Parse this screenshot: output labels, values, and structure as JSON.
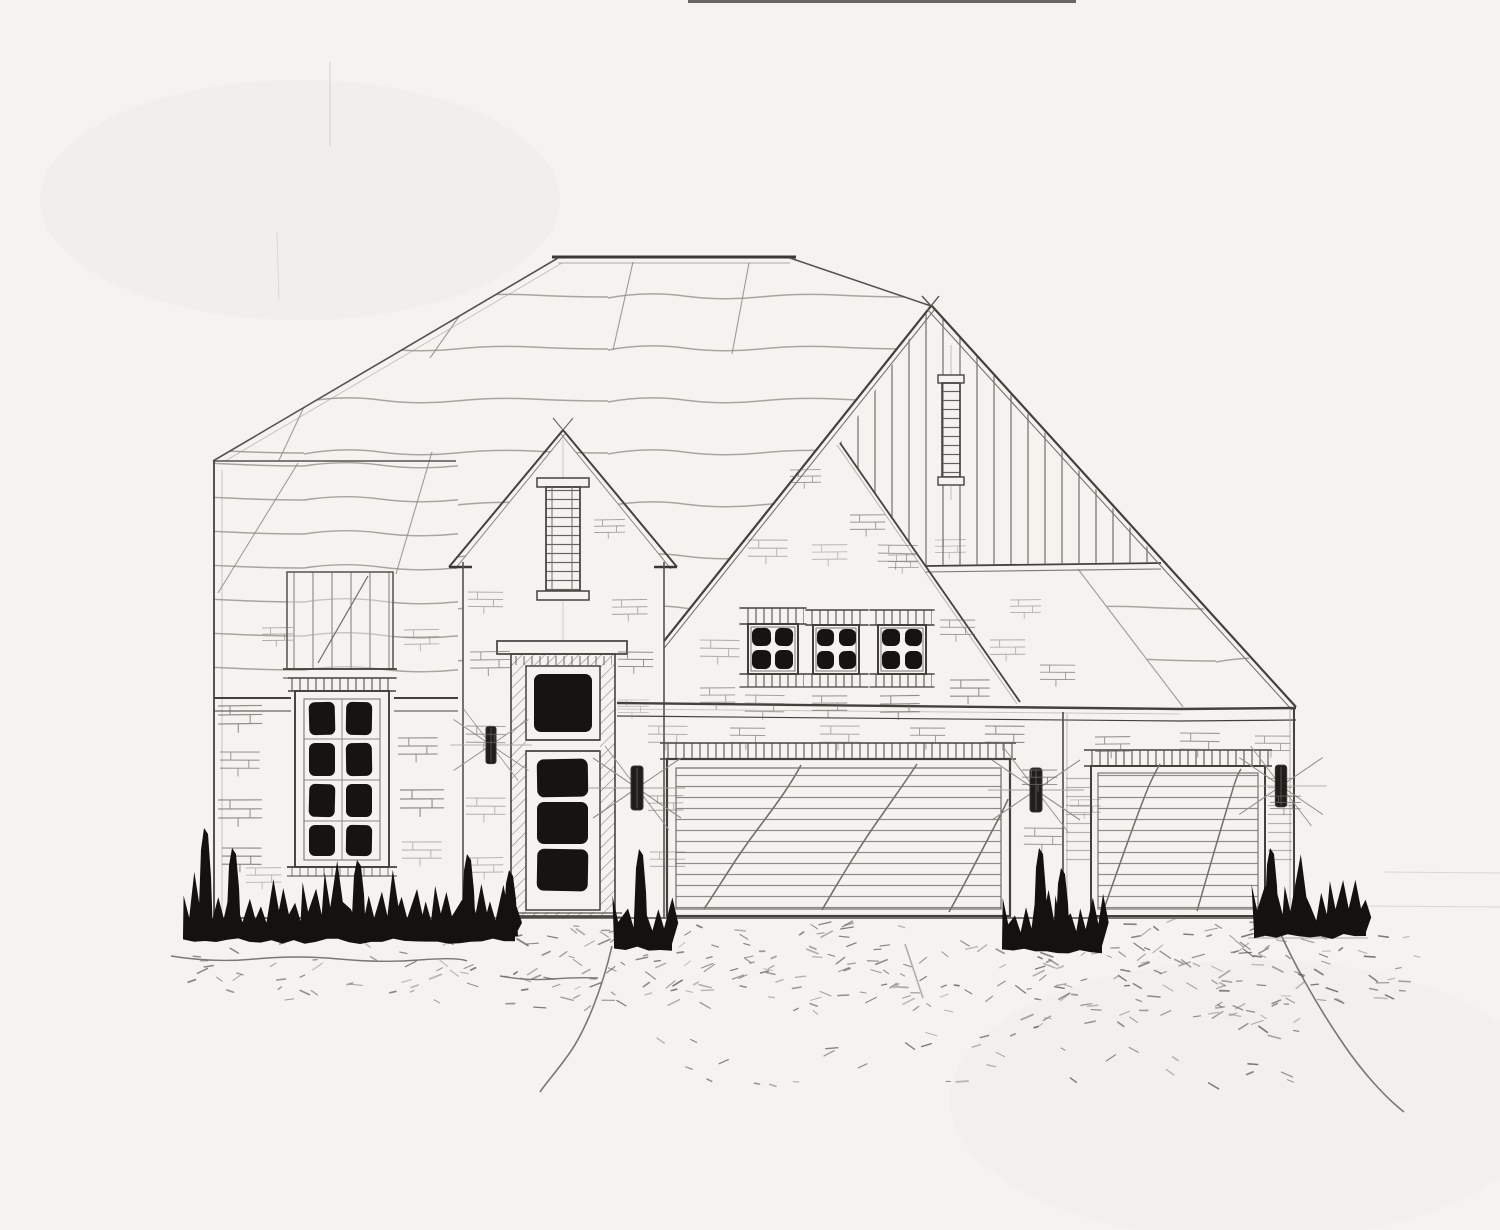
{
  "meta": {
    "title": "House Front Elevation - Pencil Sketch",
    "caption": "Hand-drawn architectural front elevation: brick house with hip roof, entry gable with glazed front door, large gable with board-and-batten siding and slot window, three four-lite windows above a two-car garage door, a single garage door, wall sconces, dark foundation shrubs and a stippled driveway."
  },
  "scene": {
    "type": "architectural front elevation sketch",
    "style": "hand-drawn pencil and ink on paper",
    "elements": [
      "hip roof with wavy shingle lines",
      "left wing with tall eight-lite window and battened bay panel",
      "entry gable with narrow ladder window",
      "front door with transom and three dark lites",
      "large right gable with vertical board-and-batten siding",
      "narrow slot window in gable siding",
      "three small four-lite windows over garage",
      "two-car garage door with diagonal accents",
      "single garage door",
      "four wall sconces with radiating sketch bursts",
      "dark ink shrubs along foundation",
      "stippled driveway and walkway with crack lines"
    ]
  },
  "palette": {
    "paper": "#f4f3f0",
    "line_faint": "#b6b2ac",
    "line_light": "#a8a49e",
    "line_mid": "#6f6c67",
    "line_dark": "#45423e",
    "ink_dark": "#161411"
  },
  "render": {
    "bushes": [
      {
        "x": 183,
        "w": 332,
        "yb": 936,
        "h": 52,
        "seed": 11,
        "spikes": [
          [
            205,
            108
          ],
          [
            233,
            88
          ],
          [
            358,
            76
          ],
          [
            468,
            82
          ],
          [
            510,
            66
          ]
        ]
      },
      {
        "x": 614,
        "w": 58,
        "yb": 944,
        "h": 58,
        "seed": 22,
        "spikes": [
          [
            640,
            95
          ]
        ]
      },
      {
        "x": 1002,
        "w": 100,
        "yb": 946,
        "h": 60,
        "seed": 33,
        "spikes": [
          [
            1040,
            98
          ],
          [
            1062,
            78
          ]
        ]
      },
      {
        "x": 1254,
        "w": 112,
        "yb": 932,
        "h": 50,
        "seed": 44,
        "spikes": [
          [
            1271,
            84
          ]
        ]
      }
    ],
    "stipple_fields": [
      [
        505,
        1020,
        924,
        1012,
        150,
        5
      ],
      [
        1020,
        1300,
        922,
        1028,
        130,
        6
      ],
      [
        1300,
        1425,
        935,
        1000,
        26,
        7
      ],
      [
        188,
        500,
        928,
        1000,
        46,
        8
      ],
      [
        560,
        1300,
        1028,
        1088,
        36,
        9
      ]
    ],
    "brick_ticks": [
      [
        218,
        706,
        1
      ],
      [
        220,
        752,
        0.9
      ],
      [
        218,
        800,
        1
      ],
      [
        222,
        848,
        0.9
      ],
      [
        246,
        868,
        0.8
      ],
      [
        398,
        738,
        0.9
      ],
      [
        400,
        790,
        1
      ],
      [
        402,
        842,
        0.9
      ],
      [
        262,
        628,
        0.7
      ],
      [
        404,
        630,
        0.8
      ],
      [
        468,
        592,
        0.8
      ],
      [
        594,
        520,
        0.7
      ],
      [
        470,
        652,
        0.9
      ],
      [
        612,
        600,
        0.8
      ],
      [
        466,
        726,
        0.9
      ],
      [
        618,
        652,
        0.8
      ],
      [
        466,
        798,
        0.9
      ],
      [
        468,
        858,
        0.8
      ],
      [
        618,
        700,
        0.7
      ],
      [
        748,
        540,
        0.9
      ],
      [
        812,
        545,
        0.8
      ],
      [
        878,
        545,
        0.9
      ],
      [
        790,
        470,
        0.7
      ],
      [
        850,
        515,
        0.8
      ],
      [
        888,
        555,
        0.7
      ],
      [
        700,
        640,
        0.9
      ],
      [
        700,
        688,
        0.8
      ],
      [
        745,
        695,
        0.9
      ],
      [
        812,
        696,
        0.8
      ],
      [
        880,
        696,
        0.9
      ],
      [
        940,
        620,
        0.8
      ],
      [
        950,
        680,
        0.9
      ],
      [
        990,
        640,
        0.8
      ],
      [
        1010,
        600,
        0.7
      ],
      [
        1040,
        665,
        0.8
      ],
      [
        935,
        540,
        0.7
      ],
      [
        648,
        726,
        0.9
      ],
      [
        730,
        728,
        0.8
      ],
      [
        820,
        726,
        0.9
      ],
      [
        910,
        728,
        0.8
      ],
      [
        985,
        726,
        0.9
      ],
      [
        1095,
        737,
        0.8
      ],
      [
        1180,
        733,
        0.9
      ],
      [
        1255,
        736,
        0.8
      ],
      [
        648,
        796,
        0.8
      ],
      [
        650,
        852,
        0.8
      ],
      [
        1022,
        770,
        0.8
      ],
      [
        1024,
        828,
        0.9
      ],
      [
        1070,
        800,
        0.7
      ],
      [
        1270,
        796,
        0.7
      ]
    ],
    "cracks": [
      "M612 946 C 603 985, 586 1032, 566 1058 C 556 1072, 546 1083, 540 1092",
      "M1277 926 C 1293 962, 1316 1004, 1342 1042 C 1362 1072, 1386 1098, 1404 1112",
      "M905 944 L 923 998"
    ],
    "walk_lines": [
      "M171 956 q 42 7 84 3 t 84 0 t 80 1 t 48 1",
      "M500 976 q 28 5 52 3 t 46 -1"
    ],
    "ground_lines": [
      [
        1248,
        938,
        1368,
        938
      ],
      [
        1363,
        906,
        1500,
        907
      ],
      [
        1385,
        872,
        1500,
        873
      ]
    ]
  }
}
